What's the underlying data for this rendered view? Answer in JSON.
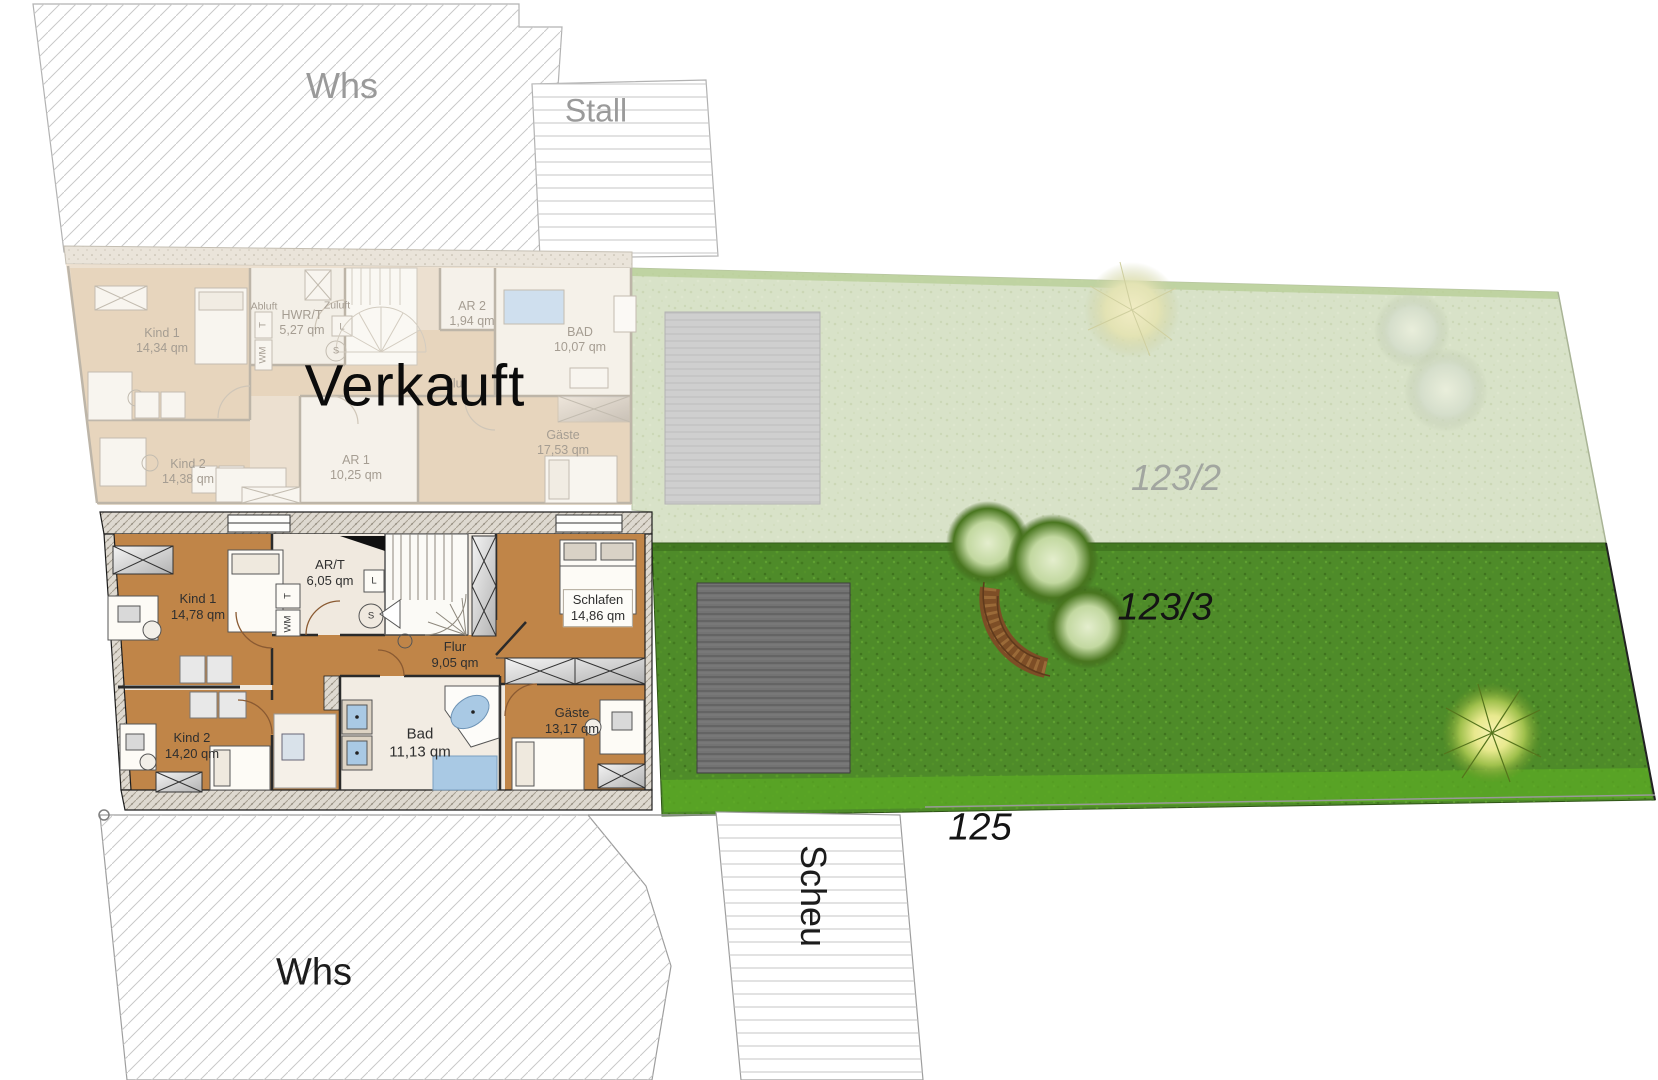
{
  "canvas": {
    "width": 1658,
    "height": 1080
  },
  "overlay": {
    "sold_label": "Verkauft"
  },
  "buildings": {
    "whs_top": "Whs",
    "stall": "Stall",
    "whs_bottom": "Whs",
    "scheu": "Scheu"
  },
  "parcels": {
    "garden_upper": "123/2",
    "garden_lower": "123/3",
    "south": "125"
  },
  "sold_plan": {
    "rooms": [
      {
        "name": "Kind 1",
        "area": "14,34 qm"
      },
      {
        "name": "Kind 2",
        "area": "14,38 qm"
      },
      {
        "name": "HWR/T",
        "area": "5,27 qm"
      },
      {
        "name": "AR 1",
        "area": "10,25 qm"
      },
      {
        "name": "AR 2",
        "area": "1,94 qm"
      },
      {
        "name": "BAD",
        "area": "10,07 qm"
      },
      {
        "name": "Flur",
        "area": ""
      },
      {
        "name": "Gäste",
        "area": "17,53 qm"
      }
    ],
    "vents": {
      "exhaust": "Abluft",
      "supply": "Zuluft"
    }
  },
  "active_plan": {
    "rooms": [
      {
        "name": "Kind 1",
        "area": "14,78 qm"
      },
      {
        "name": "AR/T",
        "area": "6,05 qm"
      },
      {
        "name": "Schlafen",
        "area": "14,86 qm"
      },
      {
        "name": "Flur",
        "area": "9,05 qm"
      },
      {
        "name": "Kind 2",
        "area": "14,20 qm"
      },
      {
        "name": "Bad",
        "area": "11,13 qm"
      },
      {
        "name": "Gäste",
        "area": "13,17 qm"
      }
    ]
  },
  "appliances": {
    "dryer": "T",
    "washer": "WM",
    "vent_l": "L",
    "siphon": "S"
  },
  "colors": {
    "grass-active": "#4e8b29",
    "grass-active-light": "#5cab24",
    "grass-faded": "#d8e2c8",
    "wood": "#c08548",
    "wood-faded": "#e7d5bd",
    "cream": "#f0e9df",
    "cream-faded": "#ece0d0",
    "bath-blue": "#a9c9e4",
    "bath-blue-faded": "#cfdfee",
    "patio-active": "#737373",
    "patio-faded": "#cfcfcf",
    "wall-dark": "#2a2a2a",
    "wall-faded": "#bdb5a8",
    "label-dark": "#2f2f2f",
    "label-faded": "#a59d92",
    "building-gray": "#9a9a9a",
    "hatch-gray": "#c9c9c9"
  }
}
